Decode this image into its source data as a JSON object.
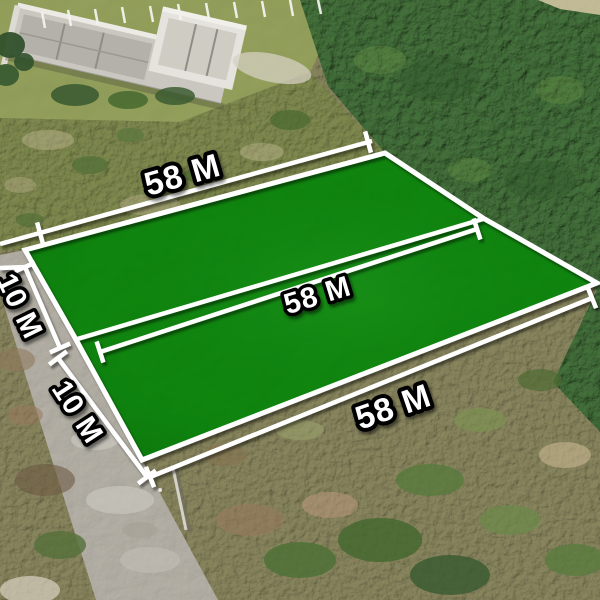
{
  "labels": {
    "top_width": "58 M",
    "middle_width": "58 M",
    "bottom_width": "58 M",
    "upper_depth": "10 M",
    "lower_depth": "10 M"
  },
  "colors": {
    "plot_green": "#0f8a11",
    "forest_green": "#41703a",
    "field_green": "#98a55e",
    "scrub_olive": "#8f8c62",
    "road_gray": "#b8b4ab",
    "line_white": "#ffffff",
    "label_fill": "#ffffff",
    "label_outline": "#000000"
  }
}
